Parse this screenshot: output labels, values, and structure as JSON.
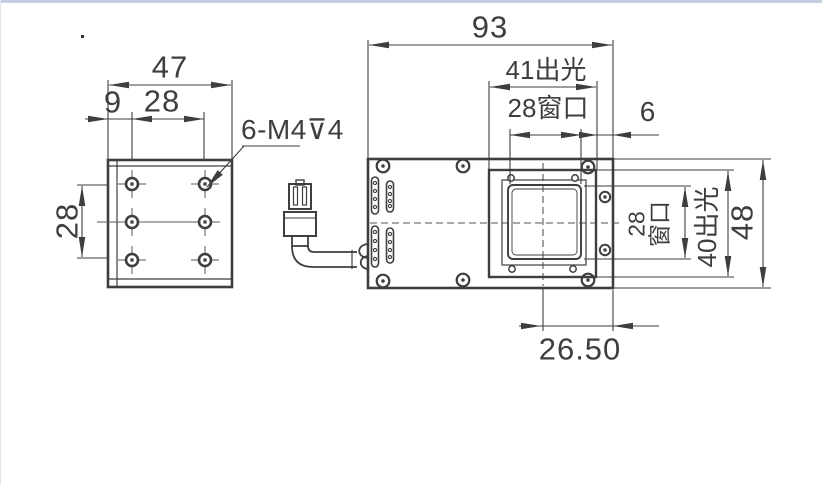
{
  "window": {
    "top_bar_color": "#c6cfe2"
  },
  "drawing": {
    "line_color": "#3e3e3e",
    "left_view": {
      "dim_width": "47",
      "dim_hole_offset": "9",
      "dim_hole_spacing_h": "28",
      "dim_hole_spacing_v": "28",
      "thread_callout": "6-M4⊽4"
    },
    "right_view": {
      "dim_overall_width": "93",
      "dim_light_width": "41出光",
      "dim_window_width": "28窗口",
      "dim_edge_offset": "6",
      "dim_window_height_value": "28",
      "dim_window_height_suffix": "窗口",
      "dim_light_height": "40出光",
      "dim_overall_height": "48",
      "dim_center_offset": "26.50"
    }
  }
}
